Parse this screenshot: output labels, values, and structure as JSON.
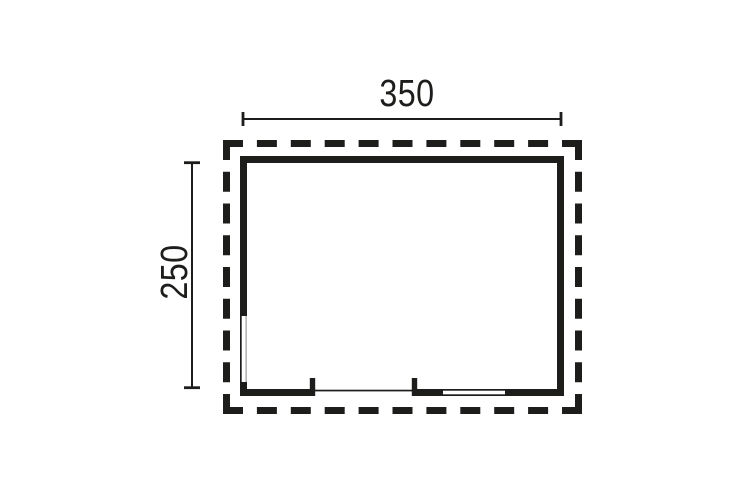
{
  "diagram": {
    "width_label": "350",
    "height_label": "250",
    "line_color": "#1d1d1b",
    "window_inner_line_color": "#9b9b9b",
    "background_color": "#ffffff"
  }
}
